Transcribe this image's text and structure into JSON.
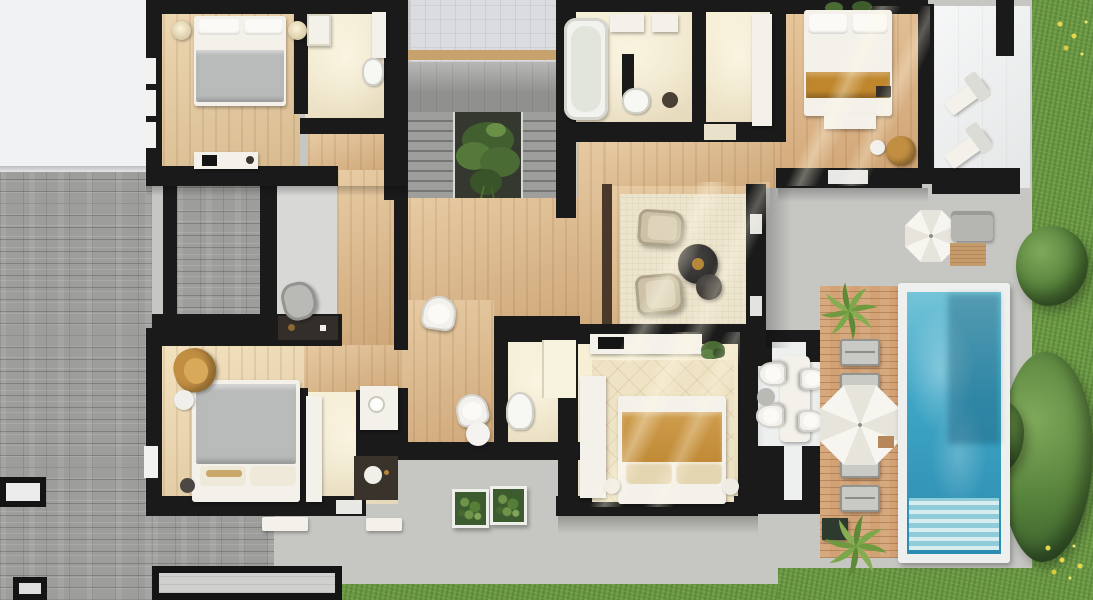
{
  "scene": {
    "type": "architectural-floor-plan-render",
    "view": "top-down 3D render",
    "floor": "upper floor of a villa with pool and garden",
    "visible_text": "none"
  },
  "palette": {
    "wall": "#1a1a1a",
    "paving": "#c6c7c3",
    "grass": "#6b9845",
    "bush": "#4e7133",
    "brick": "#9d9d9b",
    "white_roof": "#f1f2f4",
    "wood_light": "#e3c89d",
    "wood_mid": "#d9b485",
    "wood_warm": "#d9ad7c",
    "cream": "#f3ebd2",
    "cream_bright": "#f5ecce",
    "stair": "#90908e",
    "stair_void": "#34382f",
    "plant": "#5d7f41",
    "tile_terrace": "#dadce0",
    "terrace_white": "#edeff0",
    "rug": "#ece4cd",
    "rug_bc": "#eee3c4",
    "pool_frame": "#eef0ef",
    "water": "#3ea6c6",
    "water_deep": "#2c8bb0",
    "deck": "#d3a274",
    "umbrella": "#f6f4ef",
    "lounger": "#c9c9c5",
    "sofa": "#b5b6b2",
    "blanket_gray": "#b9baba",
    "blanket_tan": "#c0862c",
    "tan_chair": "#c28f42",
    "garage": "#d0d1cf",
    "gray_room": "#d8d8d6",
    "dark_wood_wall": "#4a392b",
    "pergola": "#eef0ef",
    "gold": "#b8883a",
    "skylight": "#ececec",
    "window": "#f2f2f0",
    "marble": "#3c3a38"
  },
  "rooms": [
    {
      "id": "bedroom-nw",
      "name": "Bedroom NW",
      "floor": "wood"
    },
    {
      "id": "bathroom-nw",
      "name": "Bathroom NW",
      "floor": "cream stone"
    },
    {
      "id": "study-room",
      "name": "Study / dressing room",
      "floor": "gray"
    },
    {
      "id": "stair-hall",
      "name": "Staircase hall with planted void",
      "floor": "gray stone"
    },
    {
      "id": "entry-terrace",
      "name": "Tiled terrace above stairs",
      "floor": "light tiles"
    },
    {
      "id": "bathroom-ne",
      "name": "Bathroom NE with bathtub",
      "floor": "cream stone"
    },
    {
      "id": "walk-in-closet",
      "name": "Walk-in closet",
      "floor": "cream stone"
    },
    {
      "id": "master-bedroom",
      "name": "Master bedroom",
      "floor": "warm wood"
    },
    {
      "id": "master-terrace",
      "name": "Master terrace with loungers",
      "floor": "white"
    },
    {
      "id": "sitting-area",
      "name": "Sitting area with armchairs",
      "floor": "wood + rug"
    },
    {
      "id": "reading-nook",
      "name": "Reading nook",
      "floor": "wood"
    },
    {
      "id": "bathroom-center",
      "name": "Central bathroom",
      "floor": "cream stone"
    },
    {
      "id": "bedroom-south",
      "name": "Bedroom South",
      "floor": "cream + patterned rug"
    },
    {
      "id": "bedroom-sw",
      "name": "Bedroom SW",
      "floor": "wood"
    },
    {
      "id": "bathroom-sw",
      "name": "Bathroom SW",
      "floor": "cream stone"
    },
    {
      "id": "dining-pergola",
      "name": "Outdoor dining pergola",
      "floor": "white"
    },
    {
      "id": "pool-deck",
      "name": "Wooden pool deck",
      "floor": "timber planks"
    },
    {
      "id": "pool",
      "name": "Swimming pool with steps",
      "floor": "water"
    },
    {
      "id": "garden",
      "name": "Garden lawn with shrubs",
      "floor": "grass"
    }
  ],
  "outdoor": {
    "deck_loungers": 4,
    "terrace_loungers": 2,
    "umbrellas": 2,
    "planter_boxes": 2,
    "roof_skylights": 2,
    "palm_plants": 2,
    "garden_bushes": 3
  },
  "beds": 4,
  "bathrooms": 4
}
